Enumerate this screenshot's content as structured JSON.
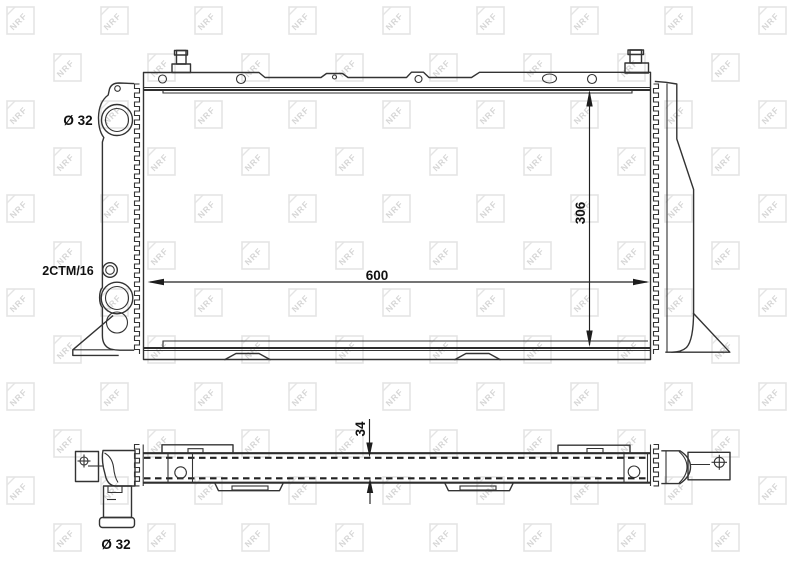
{
  "watermark": {
    "text": "NRF",
    "tile_color": "#e4e4e4",
    "letter_color": "#d6d6d6"
  },
  "front_view": {
    "inlet_diameter_label": "Ø 32",
    "variant_code_label": "2CTM/16",
    "width_dimension": "600",
    "height_dimension": "306"
  },
  "side_view": {
    "thickness_dimension": "34",
    "outlet_diameter_label": "Ø 32"
  },
  "colors": {
    "line": "#333333",
    "background": "#ffffff"
  }
}
